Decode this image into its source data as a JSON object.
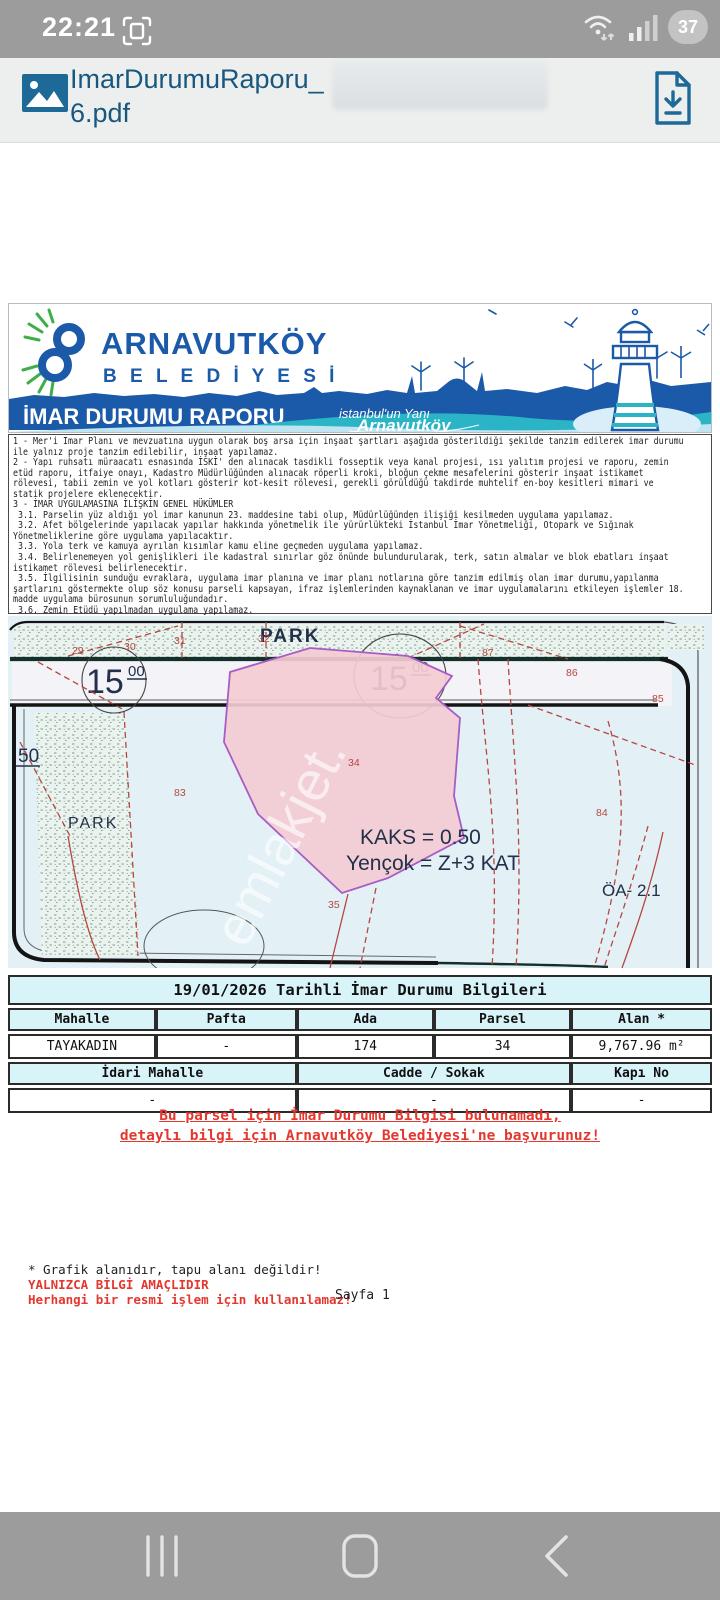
{
  "status_bar": {
    "time": "22:21",
    "battery_percent": "37"
  },
  "title_bar": {
    "filename_line1": "ImarDurumuRaporu_",
    "filename_line2": "6.pdf"
  },
  "banner": {
    "municipality_line1": "ARNAVUTKÖY",
    "municipality_line2": "B E L E D İ Y E S İ",
    "report_title": "İMAR DURUMU RAPORU",
    "slogan_line1": "istanbul'un Yanı",
    "slogan_line2": "Arnavutköy"
  },
  "notes": {
    "text": "1 - Mer'i İmar Planı ve mevzuatına uygun olarak boş arsa için inşaat şartları aşağıda gösterildiği şekilde tanzim edilerek imar durumu\nile yalnız proje tanzim edilebilir, inşaat yapılamaz.\n2 - Yapı ruhsatı müraacatı esnasında İSKİ' den alınacak tasdikli fosseptik veya kanal projesi, ısı yalıtım projesi ve raporu, zemin\netüd raporu, itfaiye onayı, Kadastro Müdürlüğünden alınacak röperli kroki, bloğun çekme mesafelerini gösterir inşaat istikamet\nrölevesi, tabii zemin ve yol kotları gösterir kot-kesit rölevesi, gerekli görüldüğü takdirde muhtelif en-boy kesitleri mimari ve\nstatik projelere eklenecektir.\n3 - İMAR UYGULAMASINA İLİŞKİN GENEL HÜKÜMLER\n 3.1. Parselin yüz aldığı yol imar kanunun 23. maddesine tabi olup, Müdürlüğünden ilişiği kesilmeden uygulama yapılamaz.\n 3.2. Afet bölgelerinde yapılacak yapılar hakkında yönetmelik ile yürürlükteki İstanbul İmar Yönetmeliği, Otopark ve Sığınak\nYönetmeliklerine göre uygulama yapılacaktır.\n 3.3. Yola terk ve kamuya ayrılan kısımlar kamu eline geçmeden uygulama yapılamaz.\n 3.4. Belirlenemeyen yol genişlikleri ile kadastral sınırlar göz önünde bulundurularak, terk, satın almalar ve blok ebatları inşaat\nistikamet rölevesi belirlenecektir.\n 3.5. İlgilisinin sunduğu evraklara, uygulama imar planına ve imar planı notlarına göre tanzim edilmiş olan imar durumu,yapılanma\nşartlarını göstermekte olup söz konusu parseli kapsayan, ifraz işlemlerinden kaynaklanan ve imar uygulamalarını etkileyen işlemler 18.\nmadde uygulama bürosunun sorumluluğundadır.\n 3.6. Zemin Etüdü yapılmadan uygulama yapılamaz."
  },
  "map": {
    "labels": {
      "park_top": "PARK",
      "park_left": "PARK",
      "road_width_1": "15",
      "road_width_1_sup": "00",
      "road_width_2": "15",
      "road_width_2_sup": "00",
      "road_width_left": "50",
      "kaks": "KAKS = 0.50",
      "yencok": "Yençok = Z+3 KAT",
      "oa": "ÖA- 2.1",
      "n29": "29",
      "n30": "30",
      "n31": "31",
      "n32": "32",
      "n34": "34",
      "n35": "35",
      "n83": "83",
      "n84": "84",
      "n85": "85",
      "n86": "86",
      "n87": "87"
    },
    "watermark": "emlakjet.",
    "colors": {
      "parcel_fill": "#f3ccd3",
      "parcel_stroke": "#a95cc5",
      "cadastral_red": "#b5473f",
      "label_navy": "#223049"
    }
  },
  "table": {
    "title": "19/01/2026 Tarihli İmar Durumu Bilgileri",
    "headers": [
      "Mahalle",
      "Pafta",
      "Ada",
      "Parsel",
      "Alan *"
    ],
    "row1": [
      "TAYAKADIN",
      "-",
      "174",
      "34",
      "9,767.96 m²"
    ],
    "headers2": [
      "İdari Mahalle",
      "Cadde / Sokak",
      "Kapı No"
    ],
    "row2": [
      "-",
      "-",
      "-"
    ]
  },
  "warning": {
    "line1": "Bu parsel için İmar Durumu Bilgisi bulunamadı,",
    "line2": "detaylı bilgi için Arnavutköy Belediyesi'ne başvurunuz!"
  },
  "footer": {
    "note1": "* Grafik alanıdır, tapu alanı değildir!",
    "note2": "YALNIZCA BİLGİ AMAÇLIDIR",
    "note3": "Herhangi bir resmi işlem için kullanılamaz!",
    "page": "Sayfa 1"
  }
}
